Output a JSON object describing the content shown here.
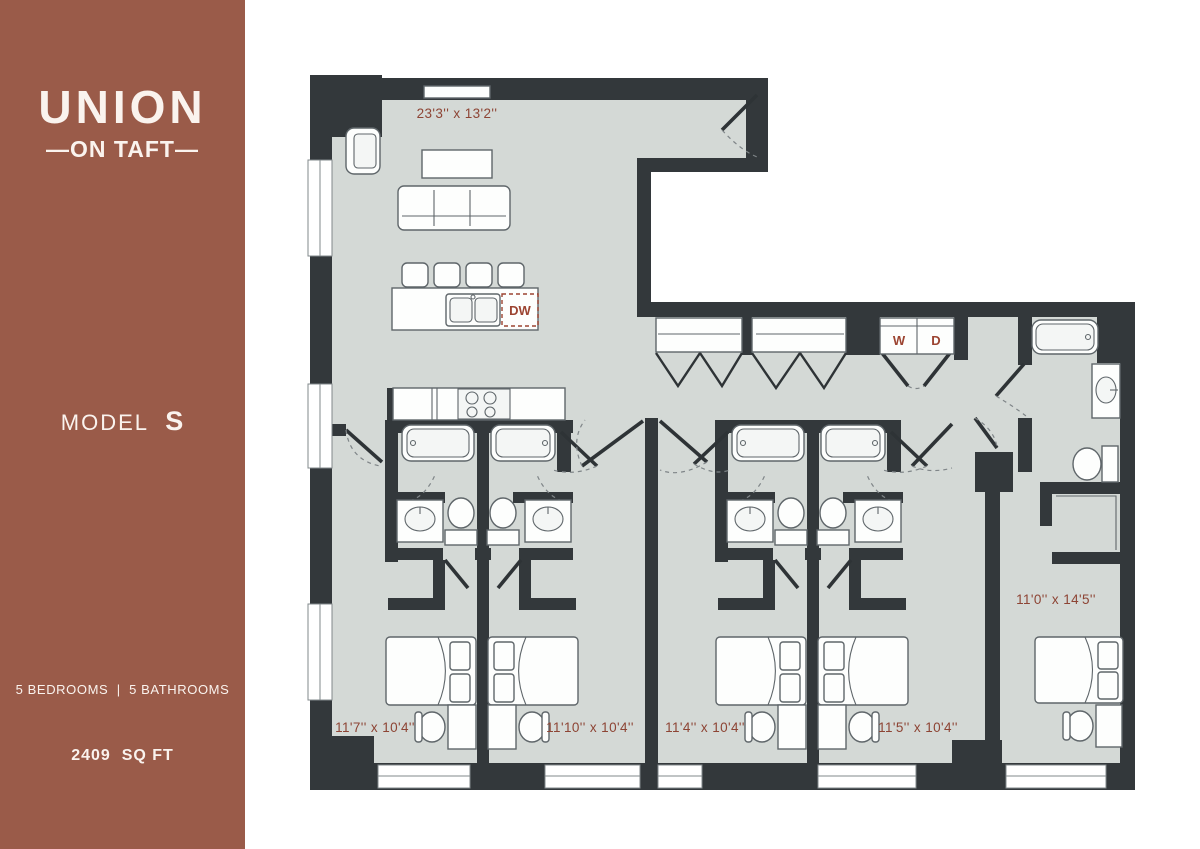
{
  "sidebar": {
    "logo_primary": "UNION",
    "logo_secondary": "—ON TAFT—",
    "model_label": "MODEL",
    "model_value": "S",
    "stats": "5 BEDROOMS  |  5 BATHROOMS",
    "area": "2409  SQ FT"
  },
  "floorplan": {
    "rooms": {
      "living": "23'3'' x 13'2''",
      "bedroom_1": "11'7'' x 10'4''",
      "bedroom_2": "11'10'' x 10'4''",
      "bedroom_3": "11'4'' x 10'4''",
      "bedroom_4": "11'5'' x 10'4''",
      "bedroom_5": "11'0'' x 14'5''"
    },
    "appliances": {
      "dishwasher": "DW",
      "washer": "W",
      "dryer": "D"
    }
  },
  "colors": {
    "sidebar_bg": "#9a5b49",
    "wall": "#33383b",
    "floor": "#d4d9d6",
    "dimension_text": "#8d4434",
    "appliance_text": "#9c4431"
  }
}
